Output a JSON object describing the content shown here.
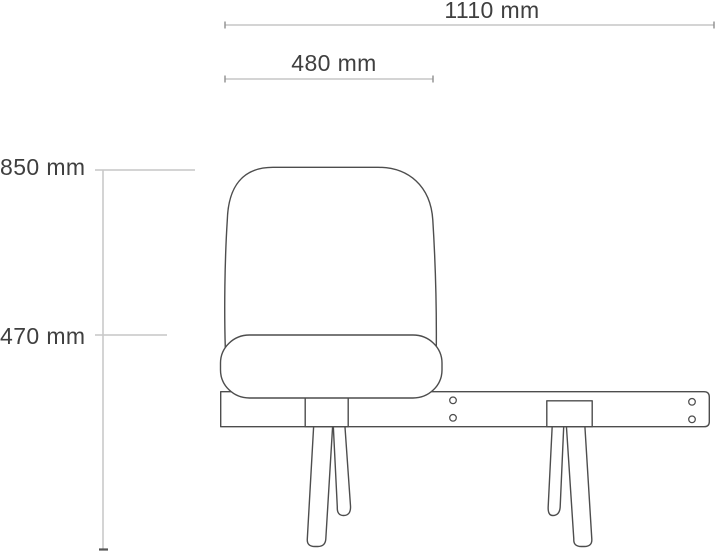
{
  "diagram": {
    "type": "technical-dimension-drawing",
    "subject": "single-seat bench chair, front elevation with dimension lines",
    "dimensions": {
      "overall_width": {
        "label": "1110 mm"
      },
      "seat_width": {
        "label": "480 mm"
      },
      "overall_height": {
        "label": "850 mm"
      },
      "seat_height": {
        "label": "470 mm"
      }
    },
    "colors": {
      "background": "#ffffff",
      "outline": "#4d4d4d",
      "dimension_line": "#a9a9a9",
      "label_text": "#3f3f3f"
    }
  }
}
